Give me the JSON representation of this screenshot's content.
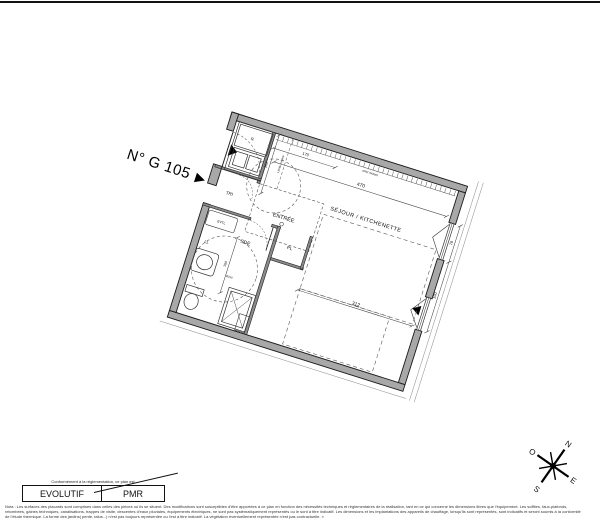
{
  "unit": {
    "label": "N° G 105",
    "pointer": "▶"
  },
  "plan": {
    "labels": {
      "sejour": "SÉJOUR / KITCHENETTE",
      "entree": "ENTRÉE",
      "sde": "SDE",
      "tri": "TRI",
      "pl": "PL",
      "ll": "LL",
      "evtl": "EVTL",
      "refrigerator": "R."
    },
    "annotations": {
      "limite_cuisine": "Limite cuisine",
      "facade_band": "volet roulant",
      "circle_diameter": "Ø150"
    },
    "dimensions": {
      "top_width": "470",
      "mid_width": "312",
      "kitchen_width": "170",
      "kitchen_depth": "162",
      "window_lower": "190",
      "window_upper": "78",
      "sde_height": "150"
    },
    "colors": {
      "wall_fill": "#a8a8a8",
      "line": "#1a1a1a",
      "dash": "#555555"
    }
  },
  "legend": {
    "conformity_text": "Conformément à la réglementation, ce plan est",
    "evolutif": "EVOLUTIF",
    "pmr": "PMR"
  },
  "compass": {
    "n": "N",
    "e": "E",
    "s": "S",
    "o": "O"
  },
  "notes": {
    "line1": "Nota : Les surfaces des placards sont comprises dans celles des pièces où ils se situent. Des modifications sont susceptibles d'être apportées à ce plan en fonction des nécessités techniques et réglementaires de la réalisation, tant en ce qui concerne les dimensions libres que l'équipement. Les soffites, faux-plafonds,",
    "line2": "retombées, gaines techniques, canalisations, trappes de visite, descentes d'eaux pluviales, équipements électriques, ne sont pas systématiquement représentés ou le sont à titre indicatif. Les dimensions et les implantations des appareils de chauffage, lorsqu'ils sont représentés, sont indicatifs et seront soumis à la conformité",
    "line3": "de l'étude thermique. La forme des jardins( pente, talus...) n'est pas toujours représentée ou l'est à titre indicatif. La végétation éventuellement représentée n'est pas contractuelle. »"
  }
}
